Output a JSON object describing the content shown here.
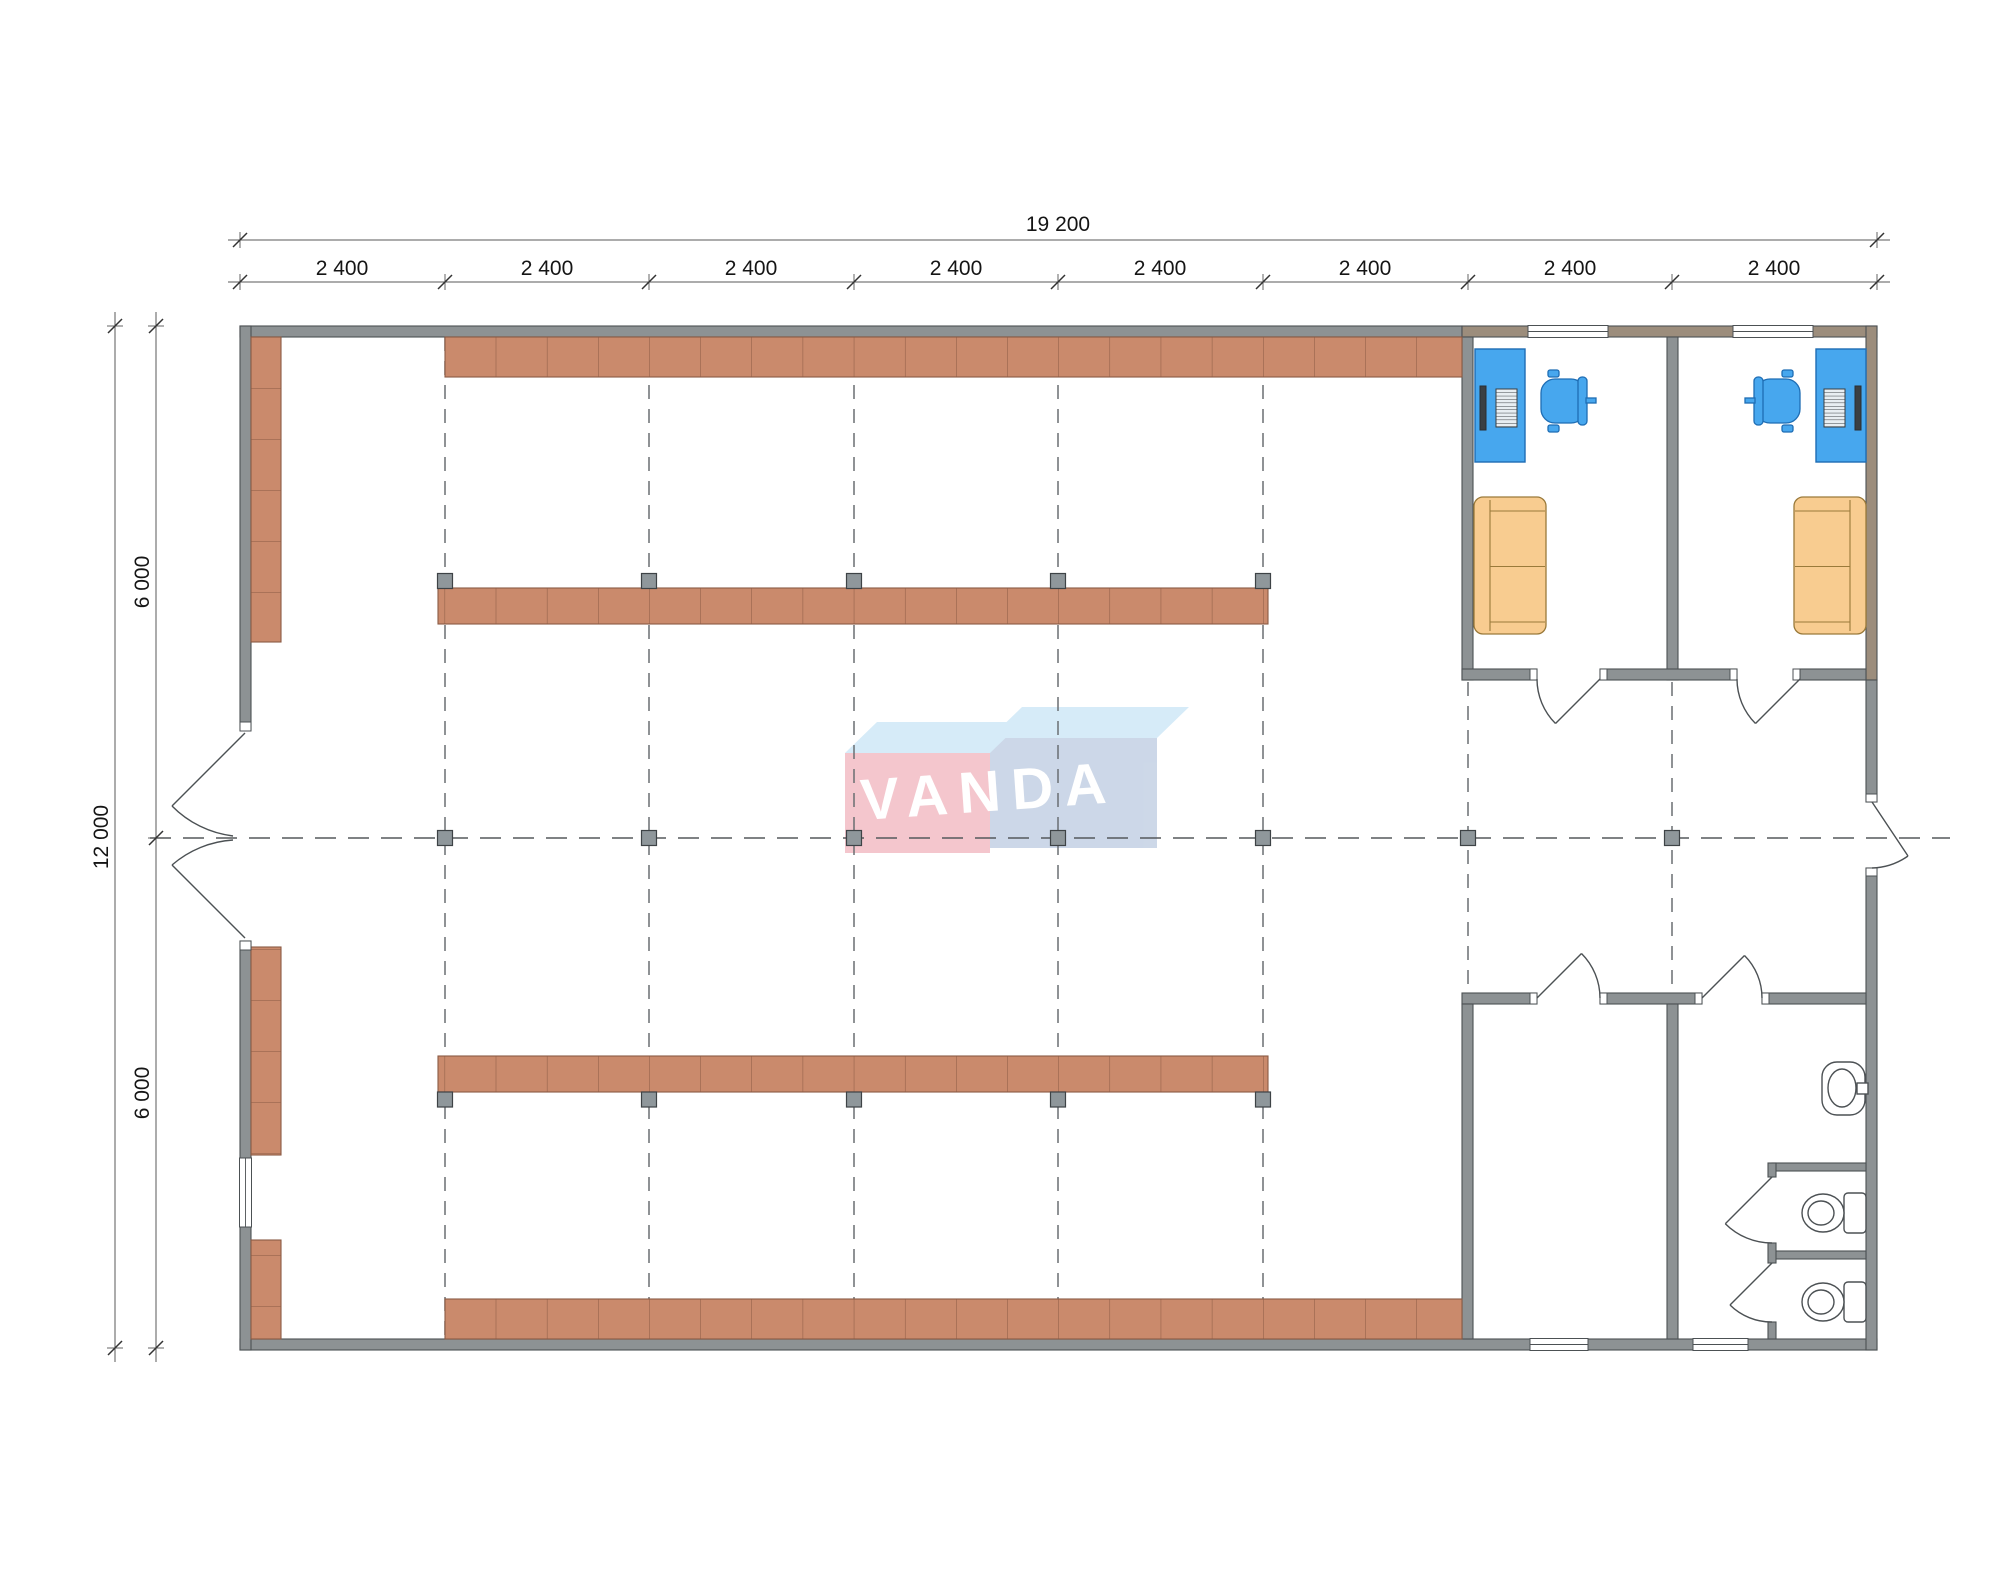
{
  "drawing": {
    "type": "architectural floor plan",
    "title": "warehouse / shop floor plan with two offices, storage room and WC"
  },
  "dimensions": {
    "top_total": "19 200",
    "top_segments": [
      "2 400",
      "2 400",
      "2 400",
      "2 400",
      "2 400",
      "2 400",
      "2 400",
      "2 400"
    ],
    "left_total": "12 000",
    "left_segments": [
      "6 000",
      "6 000"
    ]
  },
  "logo": {
    "text": "VANDA"
  },
  "fixtures": {
    "desks": 2,
    "office_chairs": 2,
    "sofas": 2,
    "toilets": 2,
    "sink": 1,
    "shelving_rows": 7,
    "columns_on_grid": 17
  },
  "colors": {
    "wall": "#8d9294",
    "wall-warm": "#9c8d7c",
    "shelf": "#ca8a6c",
    "shelf-line": "#8a5a44",
    "column": "#8f979b",
    "desk": "#47a7ee",
    "desk-line": "#1e6db4",
    "sofa": "#f8cc90",
    "sofa-line": "#9a7a3a",
    "logo-pink": "#f3bdc5",
    "logo-blue": "#c4d1e4",
    "logo-top": "#cfe8f7",
    "line": "#4c5154"
  }
}
